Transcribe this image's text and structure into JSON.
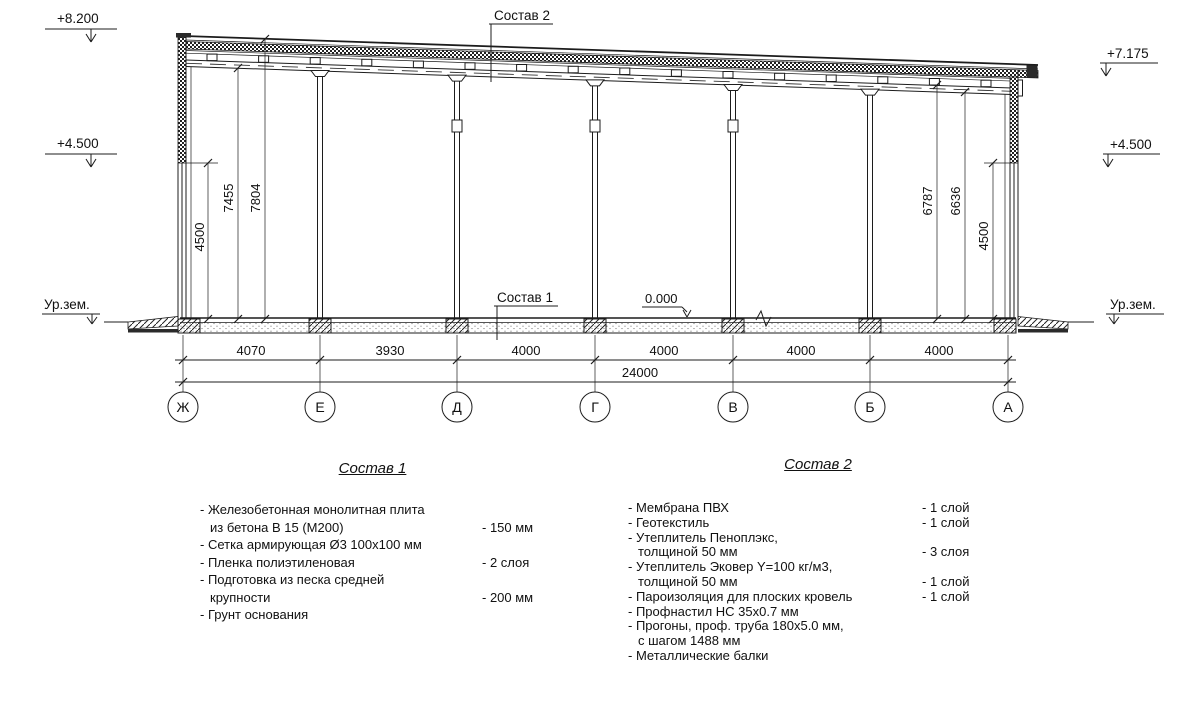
{
  "drawing": {
    "elev_left_top": "+8.200",
    "elev_left_mid": "+4.500",
    "elev_left_ground": "Ур.зем.",
    "elev_right_top": "+7.175",
    "elev_right_mid": "+4.500",
    "elev_right_ground": "Ур.зем.",
    "elev_zero": "0.000",
    "callout_roof": "Состав 2",
    "callout_floor": "Состав 1",
    "dims_left": [
      "4500",
      "7455",
      "7804"
    ],
    "dims_right": [
      "6787",
      "6636",
      "4500"
    ],
    "span_dims": [
      "4070",
      "3930",
      "4000",
      "4000",
      "4000",
      "4000"
    ],
    "total_dim": "24000",
    "axes": [
      "Ж",
      "Е",
      "Д",
      "Г",
      "В",
      "Б",
      "А"
    ]
  },
  "spec1": {
    "title": "Состав 1",
    "rows": [
      {
        "label": "- Железобетонная  монолитная плита",
        "value": ""
      },
      {
        "label": "из бетона В 15 (М200)",
        "value": "- 150 мм"
      },
      {
        "label": "- Сетка армирующая Ø3 100х100 мм",
        "value": ""
      },
      {
        "label": "- Пленка полиэтиленовая",
        "value": "-  2 слоя"
      },
      {
        "label": "- Подготовка из песка средней",
        "value": ""
      },
      {
        "label": "крупности",
        "value": "- 200 мм"
      },
      {
        "label": "- Грунт основания",
        "value": ""
      }
    ]
  },
  "spec2": {
    "title": "Состав 2",
    "rows": [
      {
        "label": "- Мембрана ПВХ",
        "value": "- 1 слой"
      },
      {
        "label": "- Геотекстиль",
        "value": "- 1 слой"
      },
      {
        "label": "- Утеплитель Пеноплэкс,",
        "value": ""
      },
      {
        "label": "толщиной 50 мм",
        "value": "- 3 слоя"
      },
      {
        "label": "- Утеплитель Эковер Y=100 кг/м3,",
        "value": ""
      },
      {
        "label": "толщиной 50 мм",
        "value": "- 1 слой"
      },
      {
        "label": "- Пароизоляция для плоских кровель",
        "value": "- 1 слой"
      },
      {
        "label": "- Профнастил НС 35х0.7 мм",
        "value": ""
      },
      {
        "label": "- Прогоны, проф. труба 180х5.0 мм,",
        "value": ""
      },
      {
        "label": "с шагом 1488 мм",
        "value": ""
      },
      {
        "label": "- Металлические балки",
        "value": ""
      }
    ]
  }
}
